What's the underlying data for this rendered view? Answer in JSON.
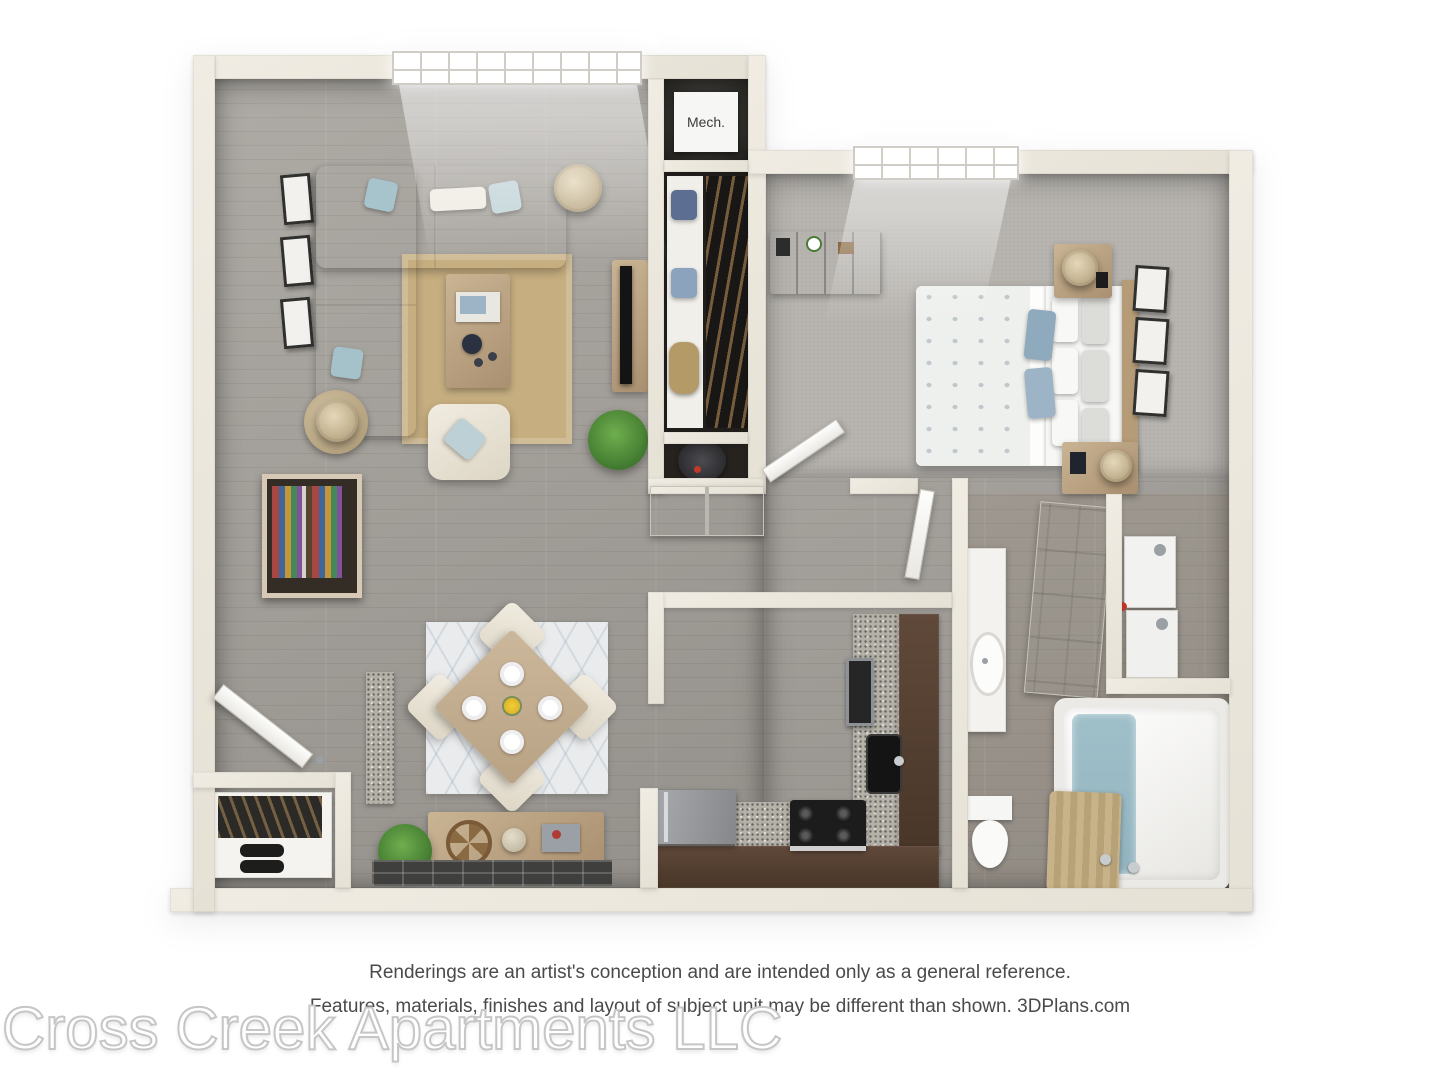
{
  "plan": {
    "mech_label": "Mech."
  },
  "footer": {
    "disclaimer_line1": "Renderings are an artist's conception and are intended only as a general reference.",
    "disclaimer_line2": "Features, materials, finishes and layout of subject unit may be different than shown. 3DPlans.com",
    "watermark": "Cross Creek Apartments LLC"
  },
  "colors": {
    "wall": "#e6e1d5",
    "wood_floor": "#a5a19b",
    "carpet": "#b5b2ad",
    "granite": "#b4b1a8",
    "cabinet": "#60493a",
    "wood_furniture": "#c9b494",
    "rug_tan": "#c6ae80",
    "rug_white": "#e9ebec",
    "accent_blue": "#a7c3cb",
    "water": "#9fbfc9",
    "plant": "#2e6423",
    "appliance": "#9a9ca0",
    "text_dark": "#4a4a4a",
    "wm_outline": "#c6c6c6"
  }
}
